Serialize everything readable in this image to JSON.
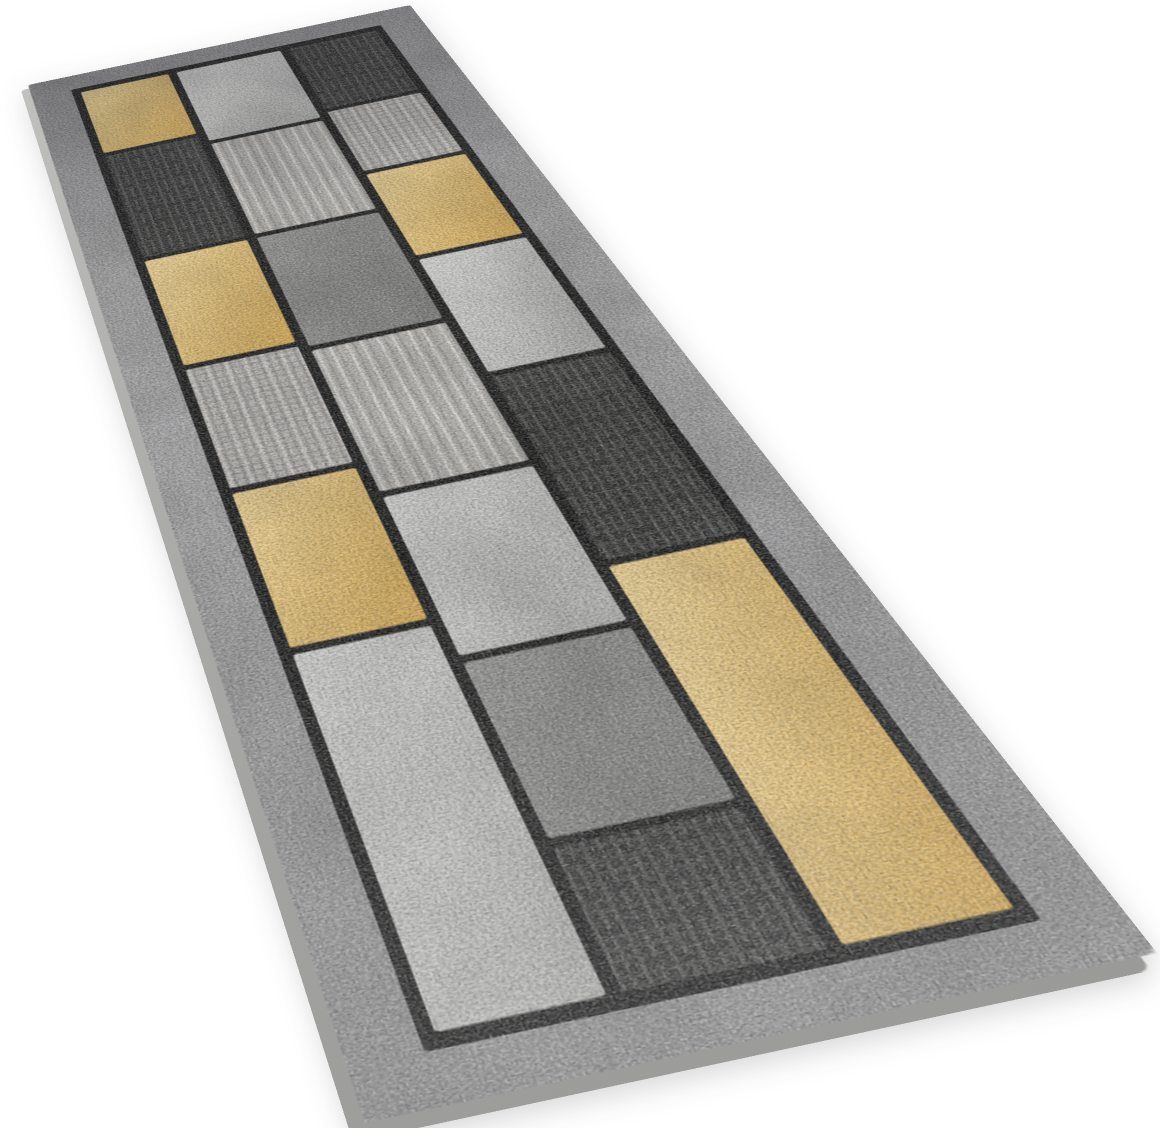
{
  "scene": {
    "description": "Product photo of a geometric patchwork carpet runner lying flat on a plain white background, photographed in perspective from the near end so the far end recedes to the upper left",
    "background_color": "#ffffff"
  },
  "rug": {
    "style": "patchwork of rectangles in gold, silver grey, medium grey and charcoal, separated by thin black seams, inside a mottled grey border with a thin black inner line",
    "border_color_light": "#a4a4a6",
    "border_color_dark": "#8d8d8f",
    "seam_color": "#161616",
    "edge_light": "#c0c0be",
    "edge_dark": "#9a9a98",
    "palette": {
      "yellow_light": "#eed392",
      "yellow_dark": "#d5a74d",
      "silver_light": "#d3d3d1",
      "silver_dark": "#aeaeac",
      "medgray_light": "#939391",
      "medgray_dark": "#777775",
      "dark_base": "#2d2d2d",
      "dark_streak": "#5e5e5c",
      "dark_cross": "#454543",
      "lightgrid_base": "#b7b5b1",
      "lightgrid_line": "#8c8a86",
      "lightgrid_hi": "#dedcd8",
      "lightstreak_base": "#b3b1ad",
      "lightstreak_hi": "#d8d6d2",
      "lightstreak_lo": "#8f8d89"
    },
    "columns": [
      {
        "width": 74,
        "patches": [
          {
            "color": "yellow",
            "len": 150
          },
          {
            "color": "dark",
            "len": 210
          },
          {
            "color": "yellow",
            "len": 180
          },
          {
            "color": "lightgrid",
            "len": 170
          },
          {
            "color": "yellow",
            "len": 180
          },
          {
            "color": "silver",
            "len": 310
          }
        ]
      },
      {
        "width": 88,
        "patches": [
          {
            "color": "silver",
            "len": 170
          },
          {
            "color": "lightstreak",
            "len": 190
          },
          {
            "color": "medgray",
            "len": 190
          },
          {
            "color": "lightstreak",
            "len": 200
          },
          {
            "color": "silver",
            "len": 180
          },
          {
            "color": "medgray",
            "len": 160
          },
          {
            "color": "dark",
            "len": 110
          }
        ]
      },
      {
        "width": 74,
        "patches": [
          {
            "color": "dark",
            "len": 155
          },
          {
            "color": "lightgrid",
            "len": 135
          },
          {
            "color": "yellow",
            "len": 160
          },
          {
            "color": "silver",
            "len": 185
          },
          {
            "color": "dark",
            "len": 235
          },
          {
            "color": "yellow",
            "len": 330
          }
        ]
      }
    ]
  }
}
